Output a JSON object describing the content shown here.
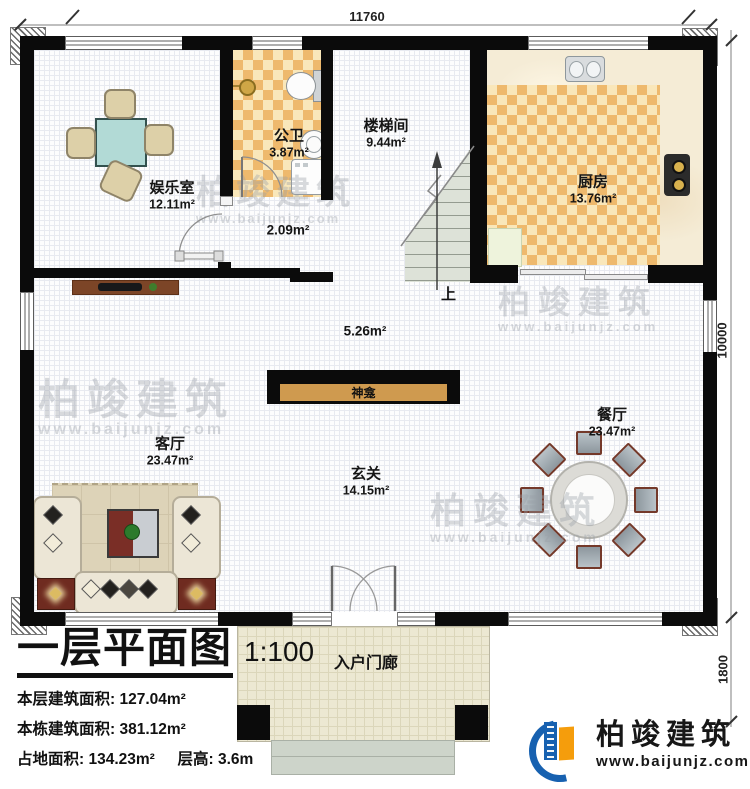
{
  "dimensions": {
    "top": "11760",
    "right": "10000",
    "porch": "1800"
  },
  "rooms": {
    "entertainment": {
      "name": "娱乐室",
      "area": "12.11m²"
    },
    "bathroom": {
      "name": "公卫",
      "area": "3.87m²"
    },
    "hallway": {
      "area": "2.09m²"
    },
    "stairwell": {
      "name": "楼梯间",
      "area": "9.44m²"
    },
    "kitchen": {
      "name": "厨房",
      "area": "13.76m²"
    },
    "corridor": {
      "area": "5.26m²"
    },
    "living": {
      "name": "客厅",
      "area": "23.47m²"
    },
    "foyer": {
      "name": "玄关",
      "area": "14.15m²"
    },
    "dining": {
      "name": "餐厅",
      "area": "23.47m²"
    },
    "porch": {
      "name": "入户门廊"
    }
  },
  "shrine": {
    "label": "神龛"
  },
  "stairs": {
    "up": "上"
  },
  "title_block": {
    "title": "一层平面图",
    "scale": "1:100",
    "stats": [
      {
        "label": "本层建筑面积:",
        "value": "127.04m²"
      },
      {
        "label": "本栋建筑面积:",
        "value": "381.12m²"
      },
      {
        "label": "占地面积:",
        "value": "134.23m²",
        "label2": "层高:",
        "value2": "3.6m"
      }
    ]
  },
  "watermark": {
    "brand": "柏竣建筑",
    "site": "www.baijunjz.com"
  },
  "logo": {
    "brand": "柏竣建筑",
    "site": "www.baijunjz.com"
  },
  "colors": {
    "wall": "#0b0b0b",
    "tile_orange": "#eeb96d",
    "tile_cream": "#f9e7ba",
    "shrine": "#cf9a4f",
    "logo_blue": "#1761b0",
    "logo_orange": "#f59d0c"
  }
}
